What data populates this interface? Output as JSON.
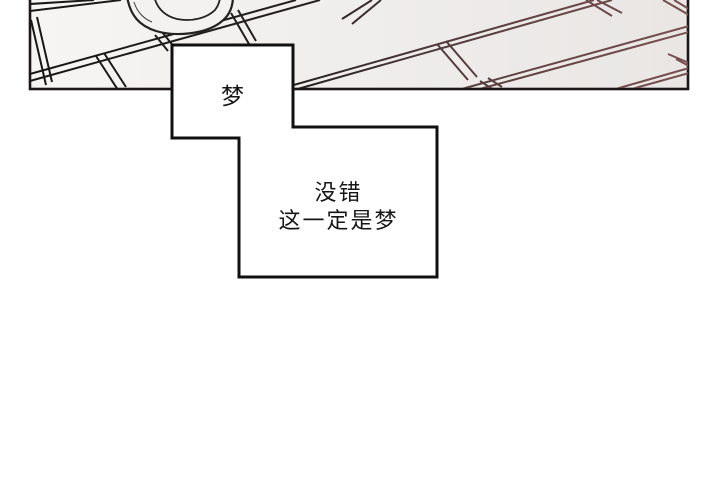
{
  "page": {
    "type": "comic-panel",
    "background_color": "#ffffff"
  },
  "panel": {
    "description": "keyboard drawn in perspective, cropped at top",
    "fill_left": "#f5f4f2",
    "fill_right": "#e9e6e4",
    "border_color": "#1b1717",
    "ink_color_left": "#181818",
    "ink_color_right": "#7a5151"
  },
  "bubbles": {
    "small": {
      "text": "梦"
    },
    "large": {
      "lines": [
        "没错",
        "这一定是梦"
      ]
    },
    "fill": "#ffffff",
    "border_color": "#101010"
  }
}
